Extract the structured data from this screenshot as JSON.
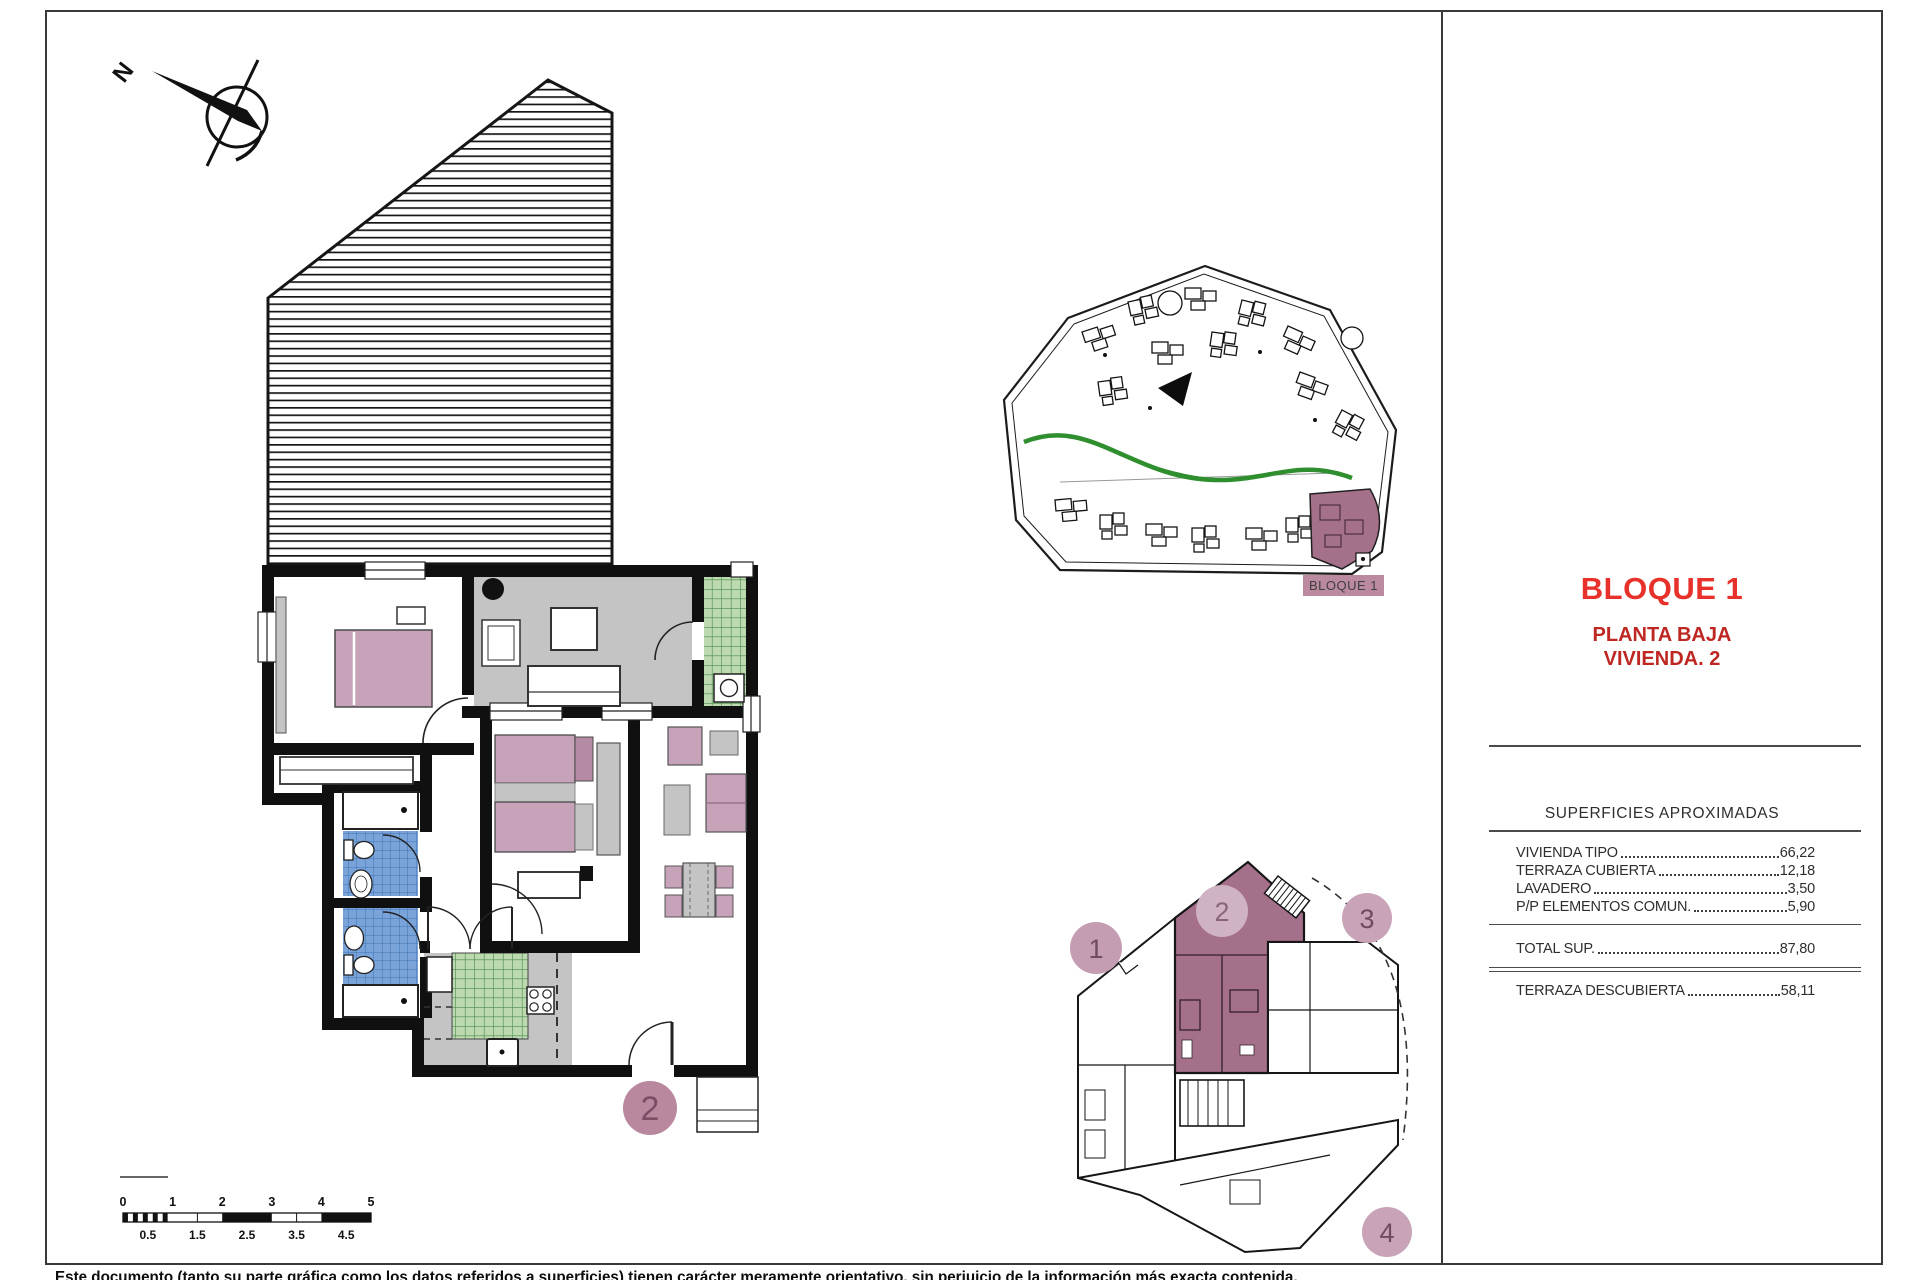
{
  "title_block": {
    "block_title": "BLOQUE 1",
    "floor_label": "PLANTA BAJA",
    "unit_label": "VIVIENDA. 2"
  },
  "areas_table": {
    "heading": "SUPERFICIES APROXIMADAS",
    "rows": [
      {
        "label": "VIVIENDA TIPO",
        "value": "66,22"
      },
      {
        "label": "TERRAZA CUBIERTA",
        "value": "12,18"
      },
      {
        "label": "LAVADERO",
        "value": "3,50"
      },
      {
        "label": "P/P ELEMENTOS COMUN.",
        "value": "5,90"
      }
    ],
    "total": {
      "label": "TOTAL SUP.",
      "value": "87,80"
    },
    "uncovered": {
      "label": "TERRAZA DESCUBIERTA",
      "value": "58,11"
    }
  },
  "site_plan": {
    "block_label": "BLOQUE 1"
  },
  "key_plan": {
    "highlighted_unit": "2",
    "units": [
      {
        "number": "1"
      },
      {
        "number": "2"
      },
      {
        "number": "3"
      },
      {
        "number": "4"
      }
    ]
  },
  "floor_plan": {
    "unit_circle_label": "2"
  },
  "compass": {
    "north_label": "N"
  },
  "scale_bar": {
    "major_labels": [
      "0",
      "1",
      "2",
      "3",
      "4",
      "5"
    ],
    "minor_labels": [
      "0.5",
      "1.5",
      "2.5",
      "3.5",
      "4.5"
    ]
  },
  "disclaimer": "Este documento (tanto su parte gráfica como los datos referidos a superficies) tienen carácter meramente orientativo, sin perjuicio de la información más exacta contenida.",
  "colors": {
    "accent_red": "#e8312b",
    "dark_red": "#bf2722",
    "mauve_furniture": "#c7a3b9",
    "unit_highlight": "#a5708a",
    "tile_green": "#bcd9b0",
    "tile_blue": "#79a3d9",
    "floor_gray": "#c4c4c4"
  }
}
